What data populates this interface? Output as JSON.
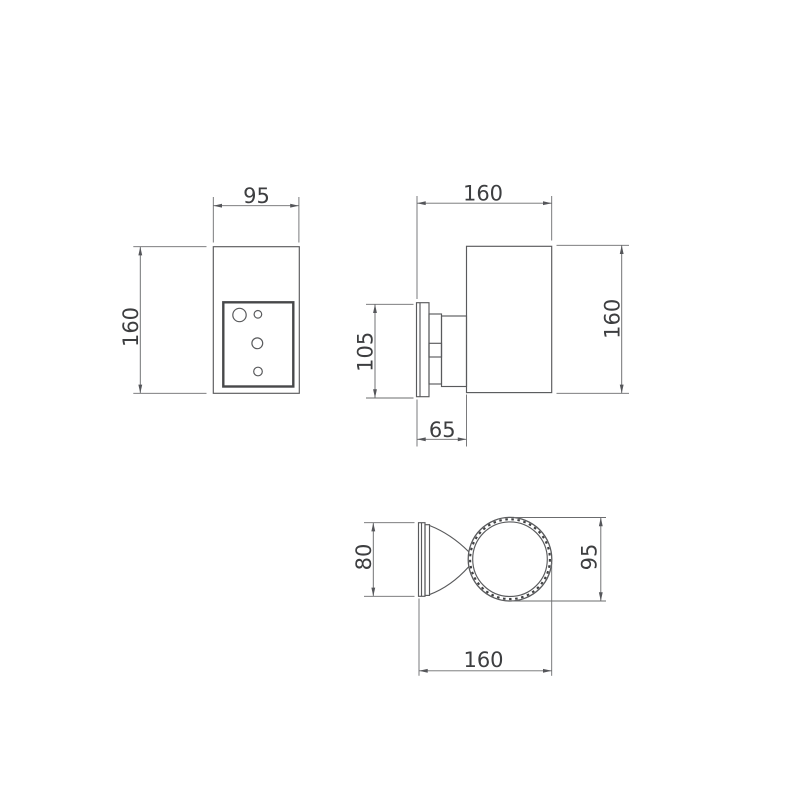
{
  "drawing": {
    "background": "#ffffff",
    "colors": {
      "outline": "#595a5c",
      "plate_outline": "#47484a",
      "dimension_lines": "#6b6c6e",
      "dimension_text": "#3d3e40"
    },
    "views": {
      "front": {
        "width_mm": "95",
        "height_mm": "160"
      },
      "side": {
        "depth_mm": "160",
        "height_mm": "160",
        "backplate_height_mm": "105",
        "bracket_depth_mm": "65"
      },
      "top": {
        "backplate_width_mm": "80",
        "body_diameter_mm": "95",
        "depth_mm": "160"
      }
    }
  }
}
